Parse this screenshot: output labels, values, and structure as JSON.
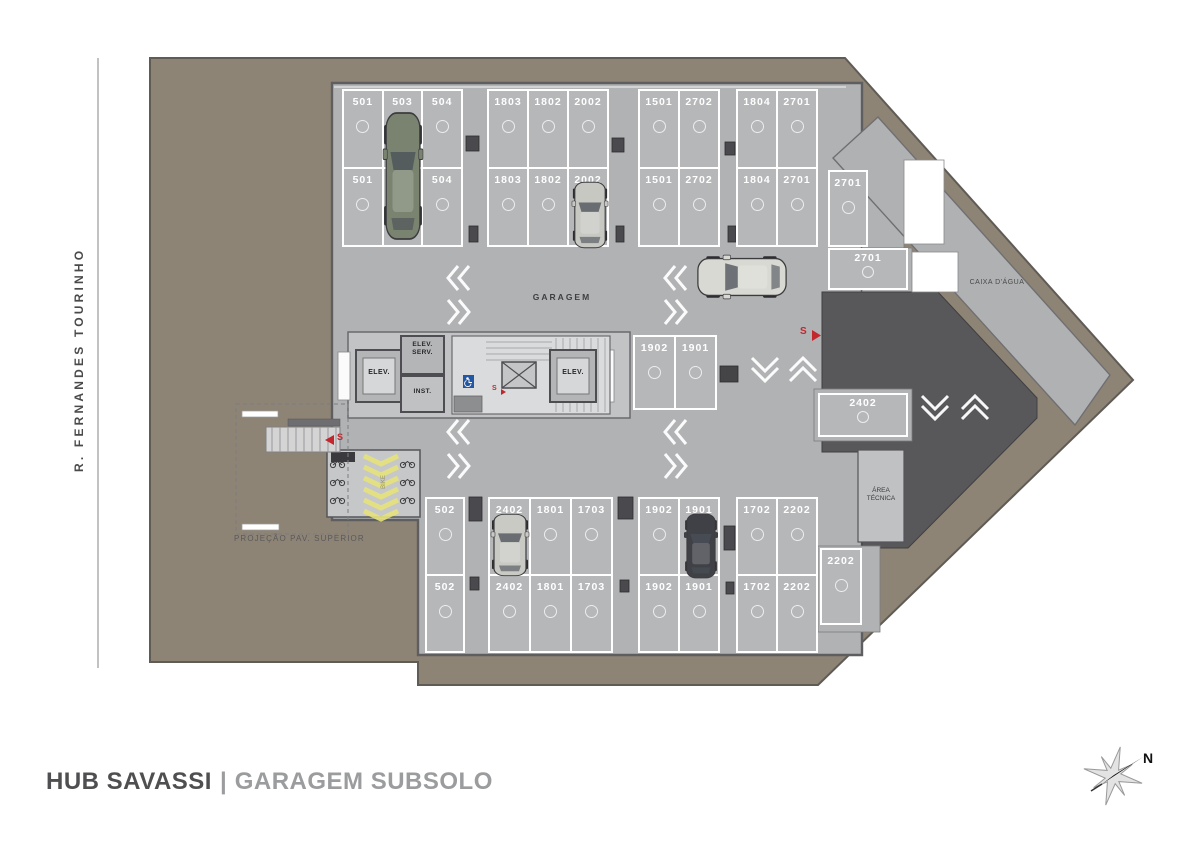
{
  "title": {
    "project": "HUB SAVASSI",
    "separator": "|",
    "floor": "GARAGEM SUBSOLO"
  },
  "street_label": "R. FERNANDES TOURINHO",
  "compass": {
    "north_label": "N"
  },
  "area_labels": {
    "garage": "GARAGEM",
    "water_tank": "CAIXA D'ÁGUA",
    "technical_area_line1": "ÁREA",
    "technical_area_line2": "TÉCNICA",
    "upper_floor_projection": "PROJEÇÃO PAV. SUPERIOR",
    "bike_lane": "BIKE"
  },
  "core": {
    "elev_left": "ELEV.",
    "elev_service_line1": "ELEV.",
    "elev_service_line2": "SERV.",
    "inst": "INST.",
    "elev_right": "ELEV.",
    "stair_up_marker": "S",
    "ramp_marker": "S",
    "entry_marker": "S"
  },
  "parking": {
    "groups": [
      {
        "id": "top-a",
        "rows": [
          [
            "501",
            "503",
            "504"
          ],
          [
            "501",
            "503",
            "504"
          ]
        ]
      },
      {
        "id": "top-b",
        "rows": [
          [
            "1803",
            "1802",
            "2002"
          ],
          [
            "1803",
            "1802",
            "2002"
          ]
        ]
      },
      {
        "id": "top-c",
        "rows": [
          [
            "1501",
            "2702"
          ],
          [
            "1501",
            "2702"
          ]
        ]
      },
      {
        "id": "top-d",
        "rows": [
          [
            "1804",
            "2701"
          ],
          [
            "1804",
            "2701"
          ]
        ]
      },
      {
        "id": "right-2701-vertical",
        "rows": [
          [
            "2701"
          ]
        ]
      },
      {
        "id": "right-2701-horizontal",
        "rows": [
          [
            "2701"
          ]
        ]
      },
      {
        "id": "mid-a",
        "rows": [
          [
            "1902",
            "1901"
          ]
        ]
      },
      {
        "id": "right-2402",
        "rows": [
          [
            "2402"
          ]
        ]
      },
      {
        "id": "bottom-502",
        "rows": [
          [
            "502"
          ],
          [
            "502"
          ]
        ]
      },
      {
        "id": "bottom-a",
        "rows": [
          [
            "2402",
            "1801",
            "1703"
          ],
          [
            "2402",
            "1801",
            "1703"
          ]
        ]
      },
      {
        "id": "bottom-b",
        "rows": [
          [
            "1902",
            "1901"
          ],
          [
            "1902",
            "1901"
          ]
        ]
      },
      {
        "id": "bottom-c",
        "rows": [
          [
            "1702",
            "2202"
          ],
          [
            "1702",
            "2202"
          ]
        ]
      },
      {
        "id": "corner-2202",
        "rows": [
          [
            "2202"
          ]
        ]
      }
    ]
  },
  "colors": {
    "terrain": "#8e8475",
    "floor": "#b1b2b4",
    "stall": "#b6b7b9",
    "ramp_dark": "#58585b",
    "accent_red": "#c1272d",
    "accessible_blue": "#2257a5",
    "bike_yellow": "#e6e27b",
    "title_dark": "#4f4f51",
    "title_light": "#9b9c9e"
  }
}
